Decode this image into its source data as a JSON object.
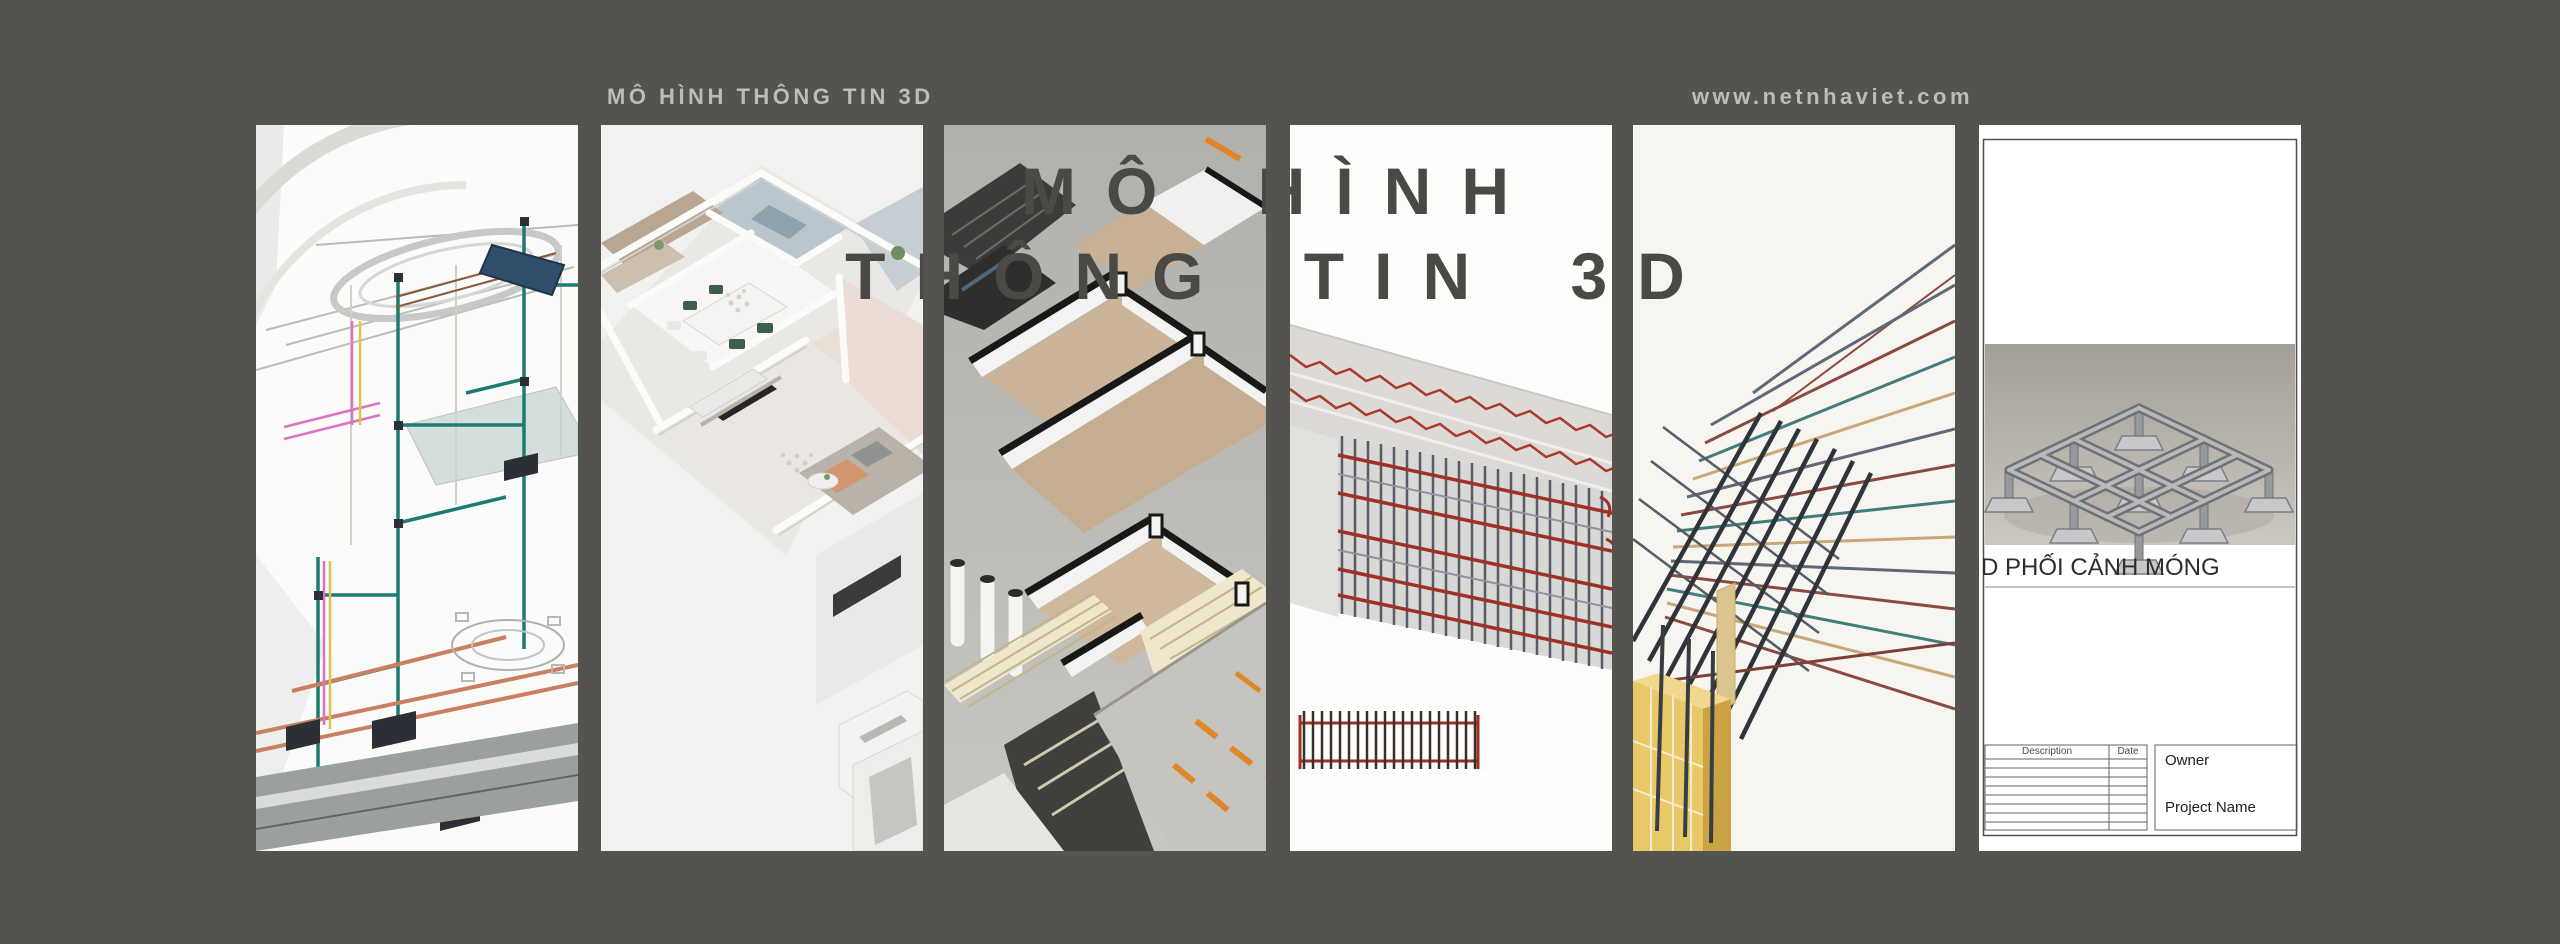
{
  "colors": {
    "background": "#555350",
    "big_title_text": "#4a4946",
    "header_text": "#bdbcba",
    "accent_orange": "#e0862a",
    "rebar_red": "#9e3025",
    "pipe_teal": "#1d7b70",
    "formwork_gold": "#e9c868"
  },
  "header": {
    "title": "MÔ HÌNH THÔNG TIN 3D",
    "website": "www.netnhaviet.com"
  },
  "big_title": {
    "line1": "MÔ HÌNH",
    "line2": "THÔNG TIN 3D"
  },
  "panels": [
    {
      "name": "mep-model",
      "alt": "3D BIM MEP wireframe model with teal, copper and pink piping, equipment boxes and rooftop solar collector"
    },
    {
      "name": "apartment-plan",
      "alt": "Isometric 3D rendered apartment floor plan with furnished living room, dining area, kitchen and bedrooms"
    },
    {
      "name": "house-section",
      "alt": "3D sectioned house model with tan wood floors, black-capped white walls and road with orange lane markings"
    },
    {
      "name": "beam-rebar",
      "alt": "Reinforced concrete beam model with red longitudinal rebar, dark stirrups and a 2D rebar elevation detail"
    },
    {
      "name": "column-rebar",
      "alt": "Rebar connection detail with fanned teal, maroon and tan bars over a gold formwork column"
    },
    {
      "name": "foundation-sheet",
      "alt": "Drawing sheet with 3D foundation perspective view and title block",
      "view_label": "D PHỐI CẢNH MÓNG",
      "titleblock": {
        "description_header": "Description",
        "date_header": "Date",
        "owner_label": "Owner",
        "project_label": "Project Name"
      }
    }
  ]
}
